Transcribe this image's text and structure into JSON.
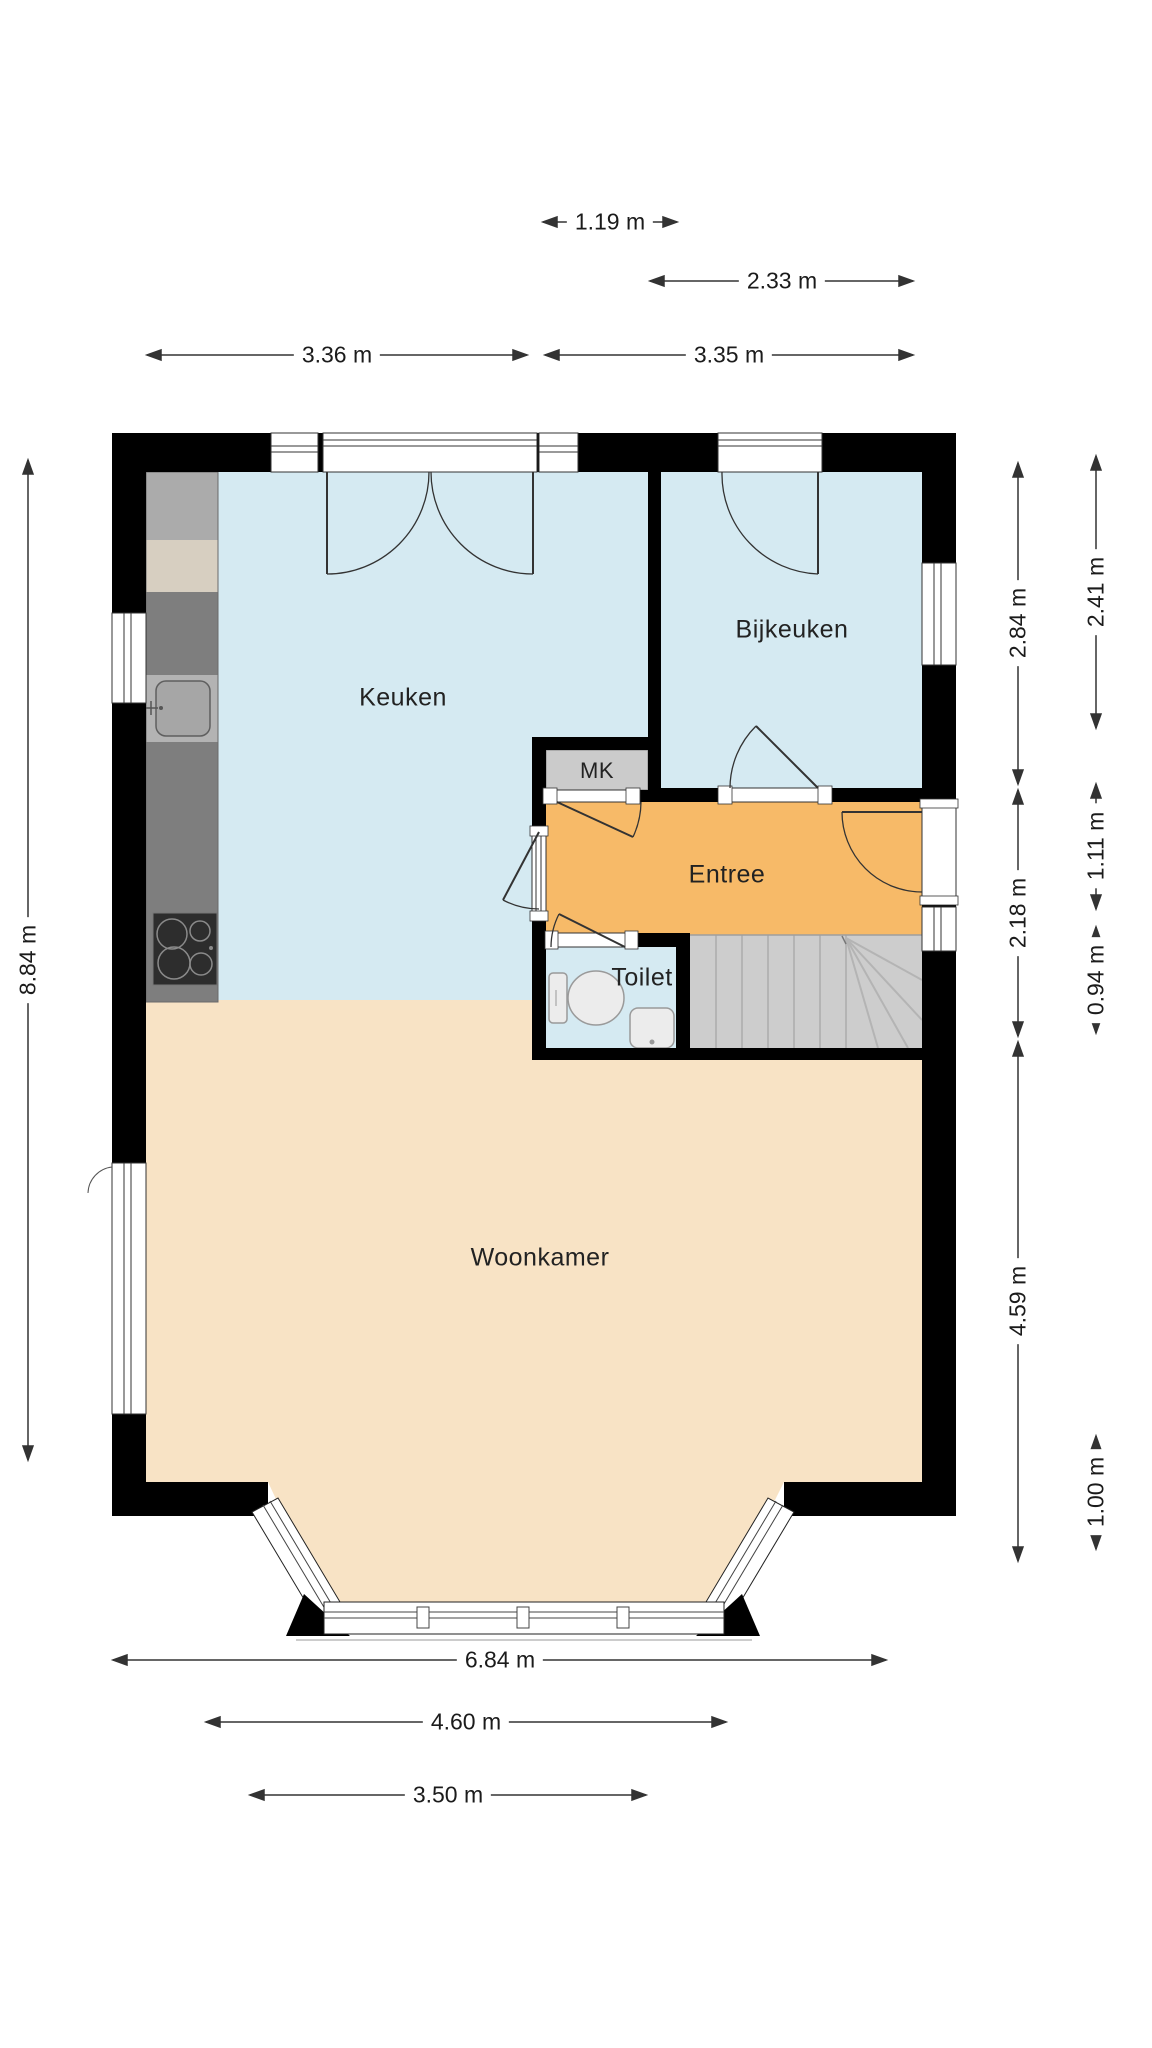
{
  "rooms": {
    "keuken": "Keuken",
    "bijkeuken": "Bijkeuken",
    "mk": "MK",
    "entree": "Entree",
    "toilet": "Toilet",
    "woonkamer": "Woonkamer"
  },
  "dimensions": {
    "top_small": "1.19 m",
    "top_mid": "2.33 m",
    "top_keuken": "3.36 m",
    "top_bijkeuken": "3.35 m",
    "left_total": "8.84 m",
    "right_inner_bijkeuken": "2.84 m",
    "right_inner_hall": "2.18 m",
    "right_inner_woonkamer": "4.59 m",
    "right_outer_bijkeuken": "2.41 m",
    "right_outer_entree": "1.11 m",
    "right_outer_toilet": "0.94 m",
    "right_outer_bay": "1.00 m",
    "bottom_total": "6.84 m",
    "bottom_bay_opening": "4.60 m",
    "bottom_bay_window": "3.50 m"
  },
  "colors": {
    "wall": "#000000",
    "room_blue": "#d5eaf2",
    "room_orange": "#f7ba68",
    "room_beige": "#f8e3c5",
    "stairs_gray": "#cdcdcd",
    "counter_dark": "#7e7e7e",
    "counter_light": "#ababab",
    "counter_beige": "#d7cfc1",
    "dimension_line": "#333333"
  }
}
